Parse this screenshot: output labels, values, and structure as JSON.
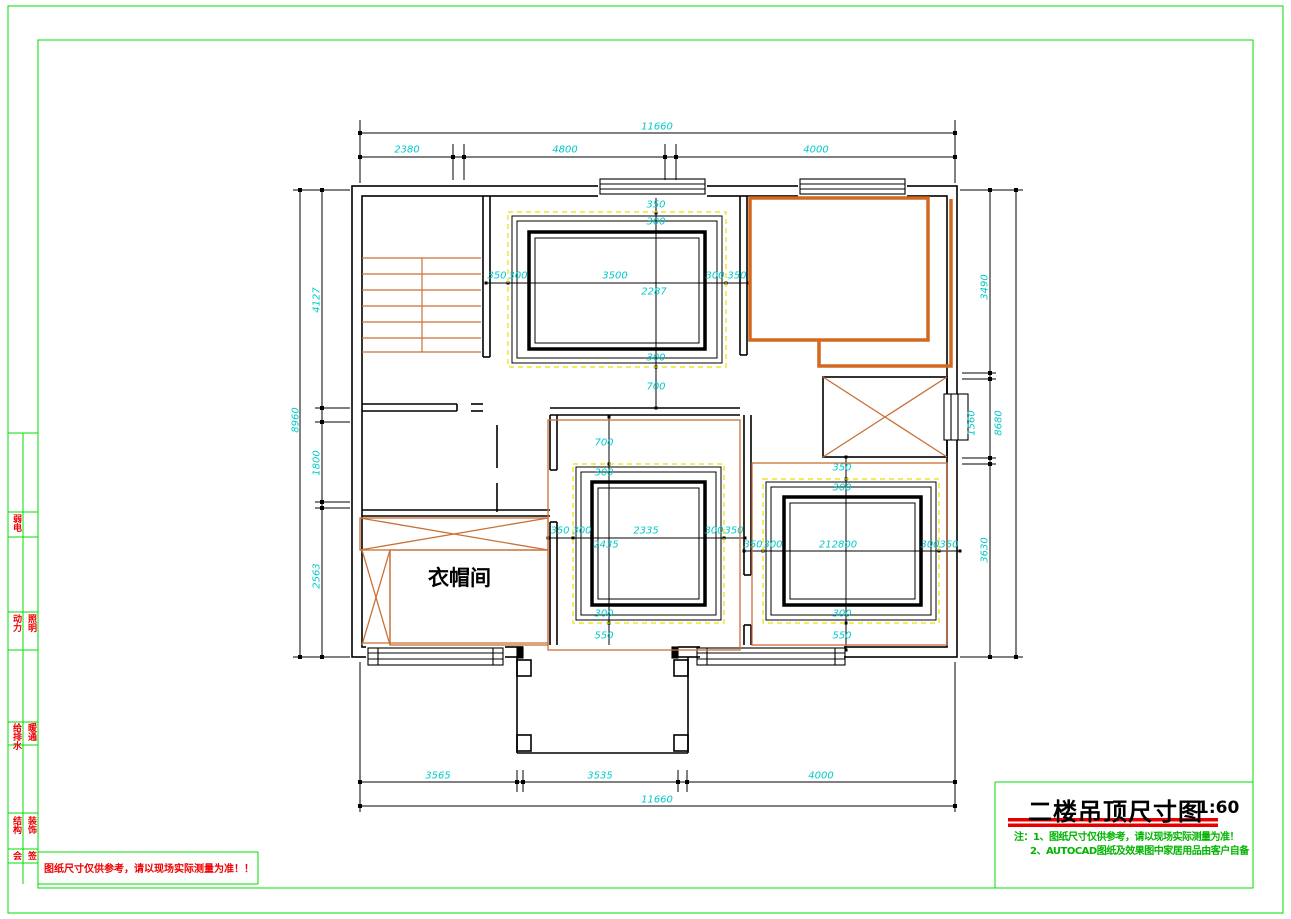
{
  "title_block": {
    "title": "二楼吊顶尺寸图",
    "scale": "1:60",
    "note1": "注：1、图纸尺寸仅供参考，请以现场实际测量为准！",
    "note2": "2、AUTOCAD图纸及效果图中家居用品由客户自备"
  },
  "warning_text": "图纸尺寸仅供参考，请以现场实际测量为准！！",
  "rooms": {
    "cloakroom": "衣帽间"
  },
  "side_strip": {
    "rows": [
      {
        "left": "弱电",
        "right": ""
      },
      {
        "left": "动力",
        "right": "照明"
      },
      {
        "left": "给排水",
        "right": "暖通"
      },
      {
        "left": "结构",
        "right": "装饰"
      },
      {
        "left": "会",
        "right": "签"
      }
    ]
  },
  "dims": {
    "top_total": "11660",
    "top_seg1": "2380",
    "top_seg2": "4800",
    "top_seg3": "4000",
    "bottom_seg1": "3565",
    "bottom_seg2": "3535",
    "bottom_seg3": "4000",
    "bottom_total": "11660",
    "left_total": "8960",
    "left_seg1": "4127",
    "left_seg2": "1800",
    "left_seg3": "2563",
    "right_seg1": "3490",
    "right_seg2": "1560",
    "right_seg3": "3630",
    "right_total": "8680",
    "a_top_offset": "350",
    "a_top_inset": "300",
    "a_left_offset": "350",
    "a_left_inset": "300",
    "a_width": "3500",
    "a_height": "2287",
    "a_right_inset": "300",
    "a_right_offset": "350",
    "a_bottom_inset": "300",
    "a_below_gap": "700",
    "hall_gap": "700",
    "b_top_inset": "300",
    "b_left_offset": "350",
    "b_left_inset": "300",
    "b_width": "2335",
    "b_height": "2435",
    "b_right_inset": "300",
    "b_right_offset": "350",
    "b_bottom_inset": "300",
    "b_below_gap": "550",
    "c_top_offset": "350",
    "c_top_inset": "300",
    "c_left_offset": "350",
    "c_left_inset": "300",
    "c_center": "212800",
    "c_right_inset": "300",
    "c_right_offset": "350",
    "c_bottom_inset": "300",
    "c_below_gap": "550"
  }
}
